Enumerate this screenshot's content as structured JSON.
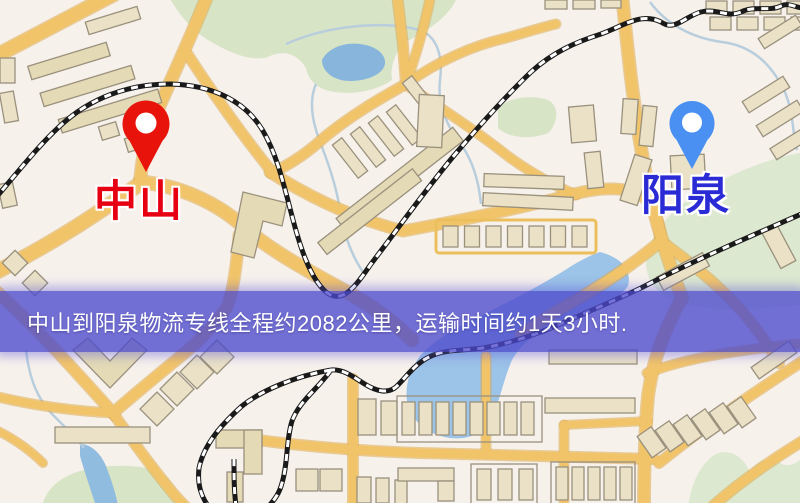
{
  "map": {
    "origin_label": "中山",
    "destination_label": "阳泉",
    "banner_text": "中山到阳泉物流专线全程约2082公里，运输时间约1天3小时.",
    "colors": {
      "origin_label": "#e60012",
      "origin_pin": "#e8140c",
      "destination_label": "#2b2bd5",
      "destination_pin": "#4a90f2",
      "banner_background": "#4d4acd",
      "banner_text": "#ffffff",
      "road": "#f2c46a",
      "railway": "#1a1a1a",
      "water": "#9cc3e8",
      "park": "#d7e4c5",
      "building": "#eae1c6",
      "map_background": "#f7f1ec"
    }
  }
}
